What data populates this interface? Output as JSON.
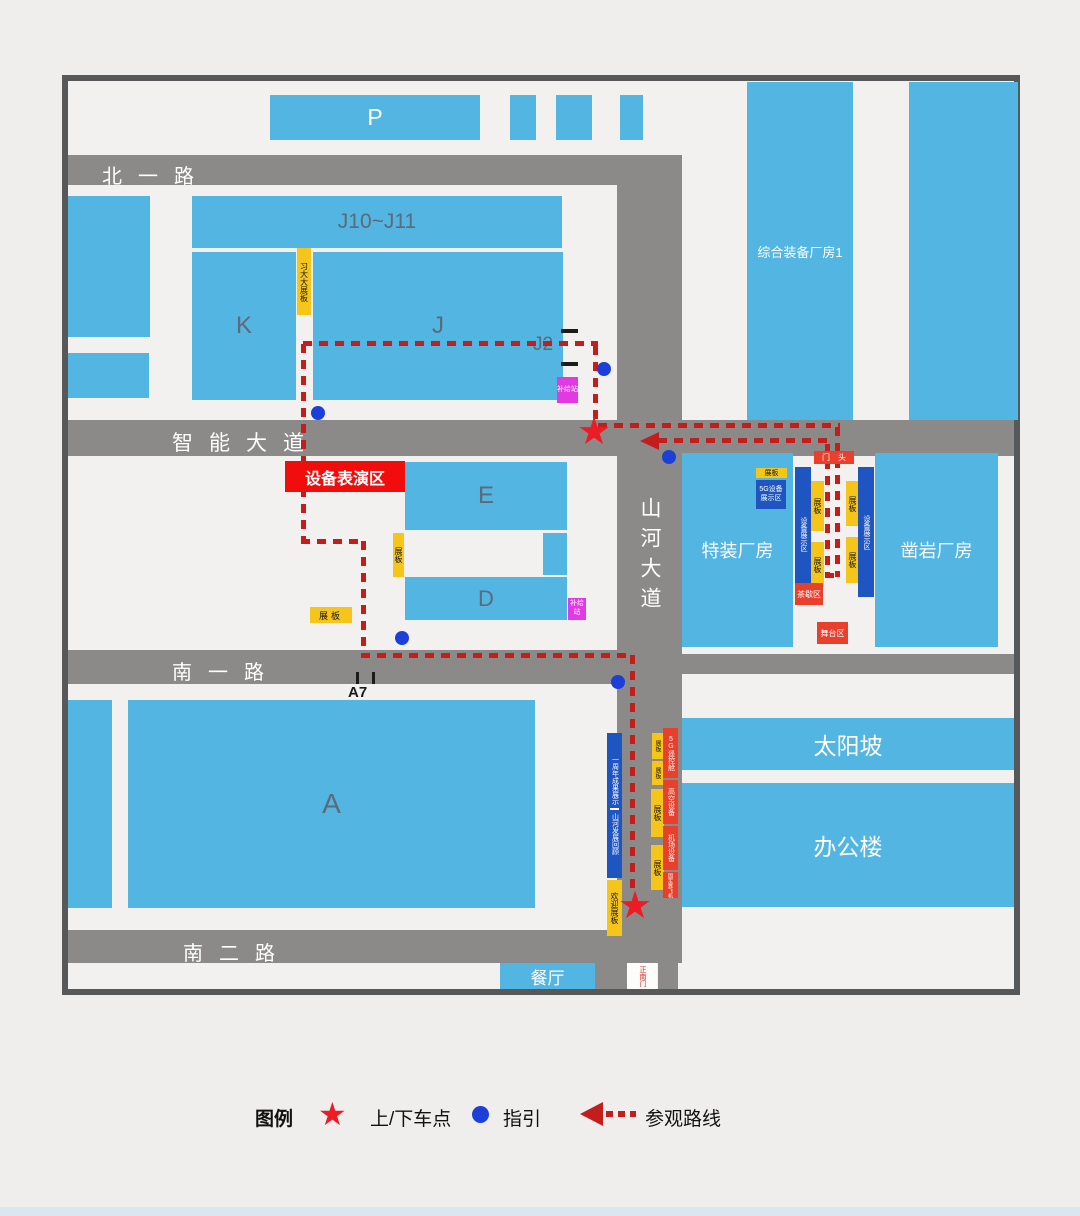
{
  "map": {
    "roads": {
      "north1": "北一路",
      "zhineng": "智能大道",
      "shanhe": "山河大道",
      "south1": "南一路",
      "south2": "南二路"
    },
    "buildings": {
      "p": "P",
      "j1011": "J10~J11",
      "k": "K",
      "j": "J",
      "j2": "J2",
      "e": "E",
      "d": "D",
      "a": "A",
      "a7": "A7",
      "zonghe": "综合装备厂房1",
      "tezhuang": "特装厂房",
      "zaoyan": "凿岩厂房",
      "taiyangpo": "太阳坡",
      "bangonglou": "办公楼",
      "canting": "餐厅"
    },
    "markers": {
      "perf_area": "设备表演区",
      "xi_board": "习大大展板",
      "supply": "补给站",
      "board": "展板",
      "g5_zone": "5G设备展示区",
      "equip_zone": "设备展示区",
      "tea_area": "茶歇区",
      "stage_area": "舞台区",
      "gate_head": "门头",
      "anniv": "一周年成果展示",
      "review": "山河发展回顾",
      "welcome": "欢迎展板",
      "south_gate": "正南门",
      "exhibits": [
        "5G遥控舱",
        "高空设备",
        "机场设备",
        "固定翼飞机"
      ]
    }
  },
  "legend": {
    "title": "图例",
    "stop": "上/下车点",
    "guide": "指引",
    "route": "参观路线"
  },
  "colors": {
    "bg": "#efeeec",
    "map_bg": "#f2f1ef",
    "frame_gray": "#57585a",
    "road_gray": "#8b8a88",
    "building_blue": "#53b5e2",
    "deep_blue": "#1e55c0",
    "route_red": "#c41e1c",
    "star_red": "#ed1c24",
    "accent_red": "#e8402d",
    "perf_red": "#f20d0d",
    "yellow": "#f6c51a",
    "magenta": "#e23ae2",
    "dot_blue": "#1b3fd8",
    "label_slate": "#5b6b78",
    "bottom_strip": "#d8e7f1"
  }
}
